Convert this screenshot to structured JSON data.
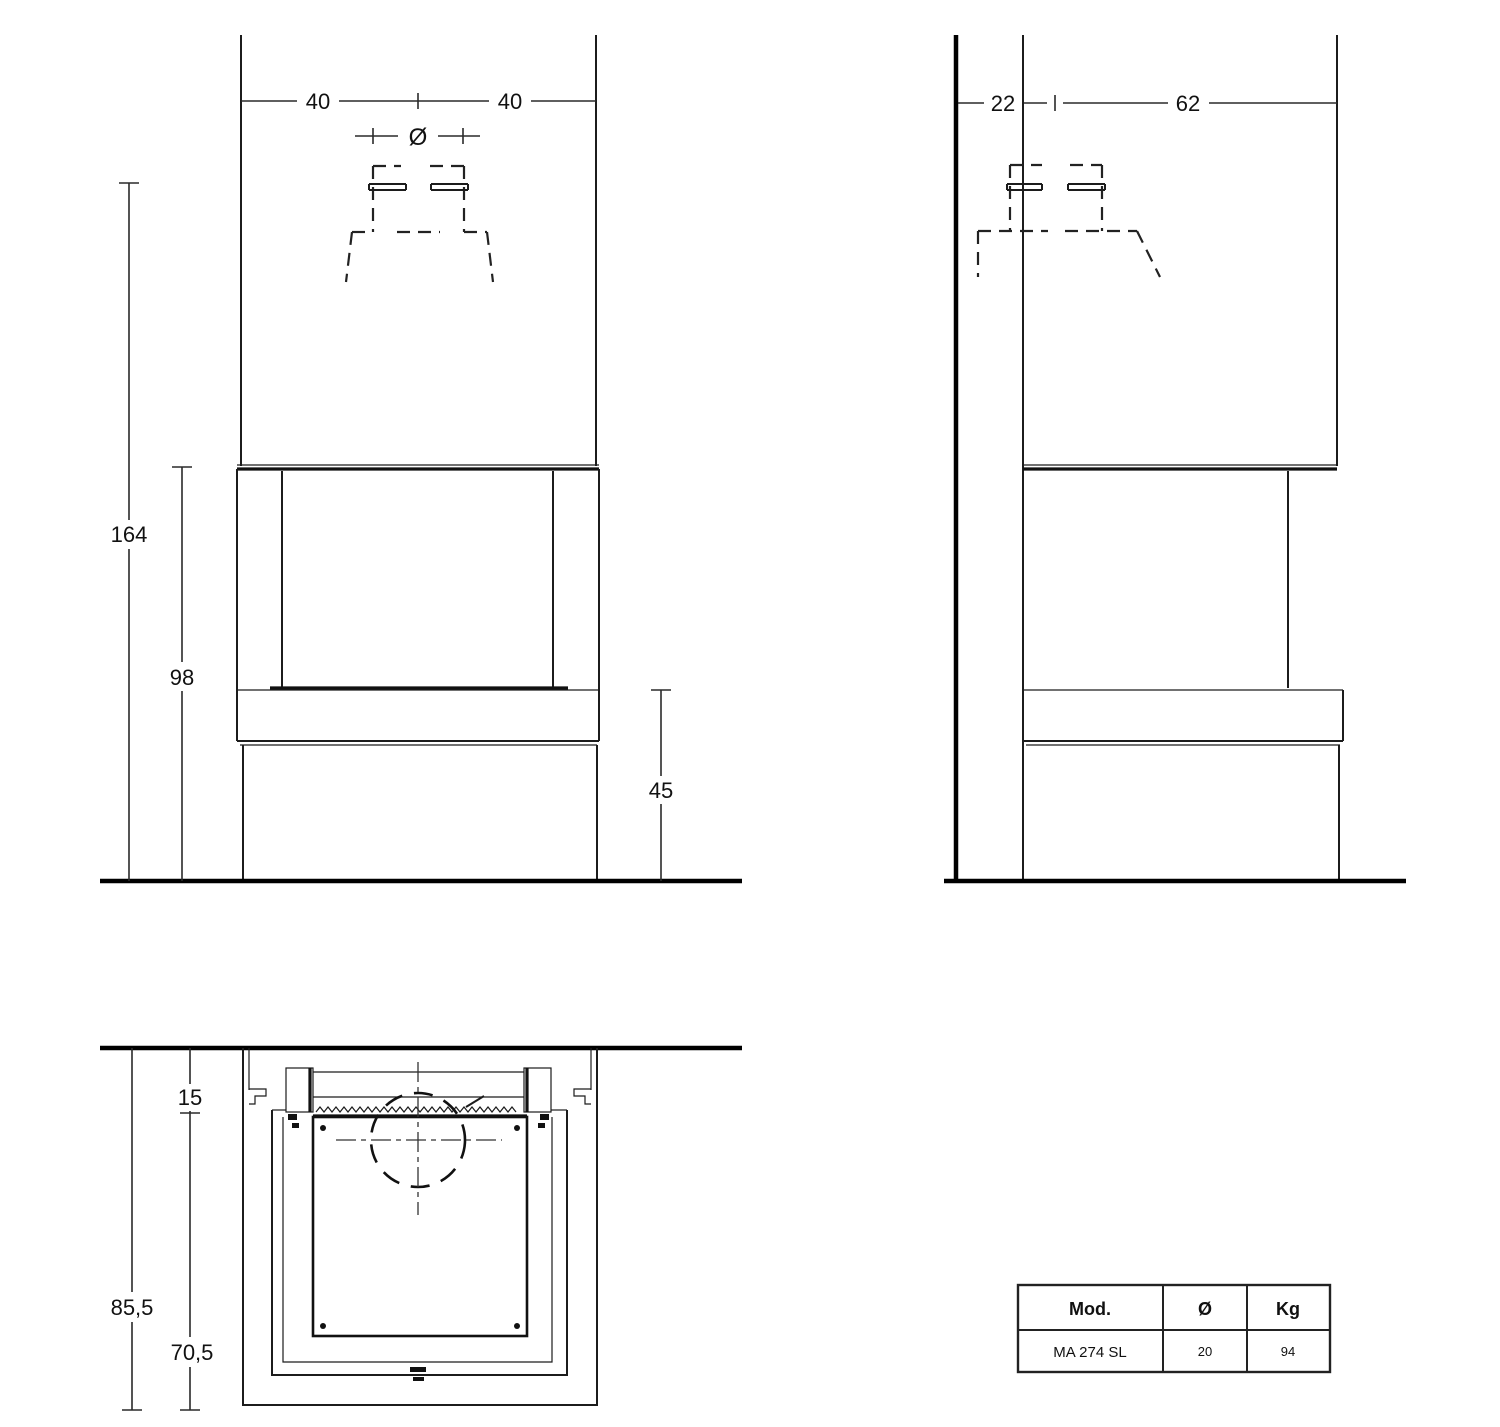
{
  "drawing": {
    "front_view": {
      "dims": {
        "width_left": "40",
        "width_right": "40",
        "flue_diameter_symbol": "Ø",
        "height_total": "164",
        "height_opening": "98",
        "height_bench": "45"
      }
    },
    "side_view": {
      "dims": {
        "depth_back": "22",
        "depth_front": "62"
      }
    },
    "plan_view": {
      "dims": {
        "wall_gap": "15",
        "depth_total": "85,5",
        "depth_unit": "70,5"
      }
    },
    "spec_table": {
      "headers": [
        "Mod.",
        "Ø",
        "Kg"
      ],
      "row": [
        "MA 274 SL",
        "20",
        "94"
      ]
    }
  }
}
